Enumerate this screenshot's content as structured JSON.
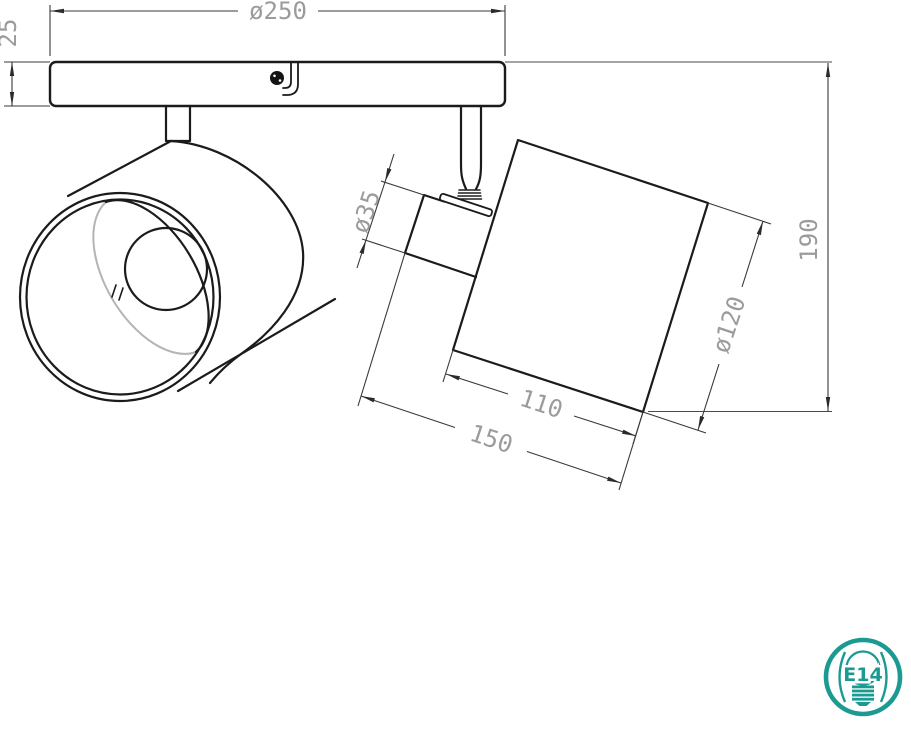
{
  "drawing": {
    "kind": "technical dimension drawing",
    "subject": "two-light adjustable ceiling spotlight",
    "units": "mm"
  },
  "dims": {
    "plate_diameter": "ø250",
    "plate_thickness": "25",
    "neck_diameter": "ø35",
    "shade_diameter": "ø120",
    "shade_length": "110",
    "head_length": "150",
    "overall_height": "190"
  },
  "badge": {
    "socket": "E14"
  },
  "colors": {
    "line": "#1b1b1b",
    "dim_line": "#3a3a3a",
    "dim_text": "#9b9b9b",
    "hidden_edge": "#b4b4b4",
    "badge_teal": "#1b9a92",
    "background": "#ffffff"
  }
}
